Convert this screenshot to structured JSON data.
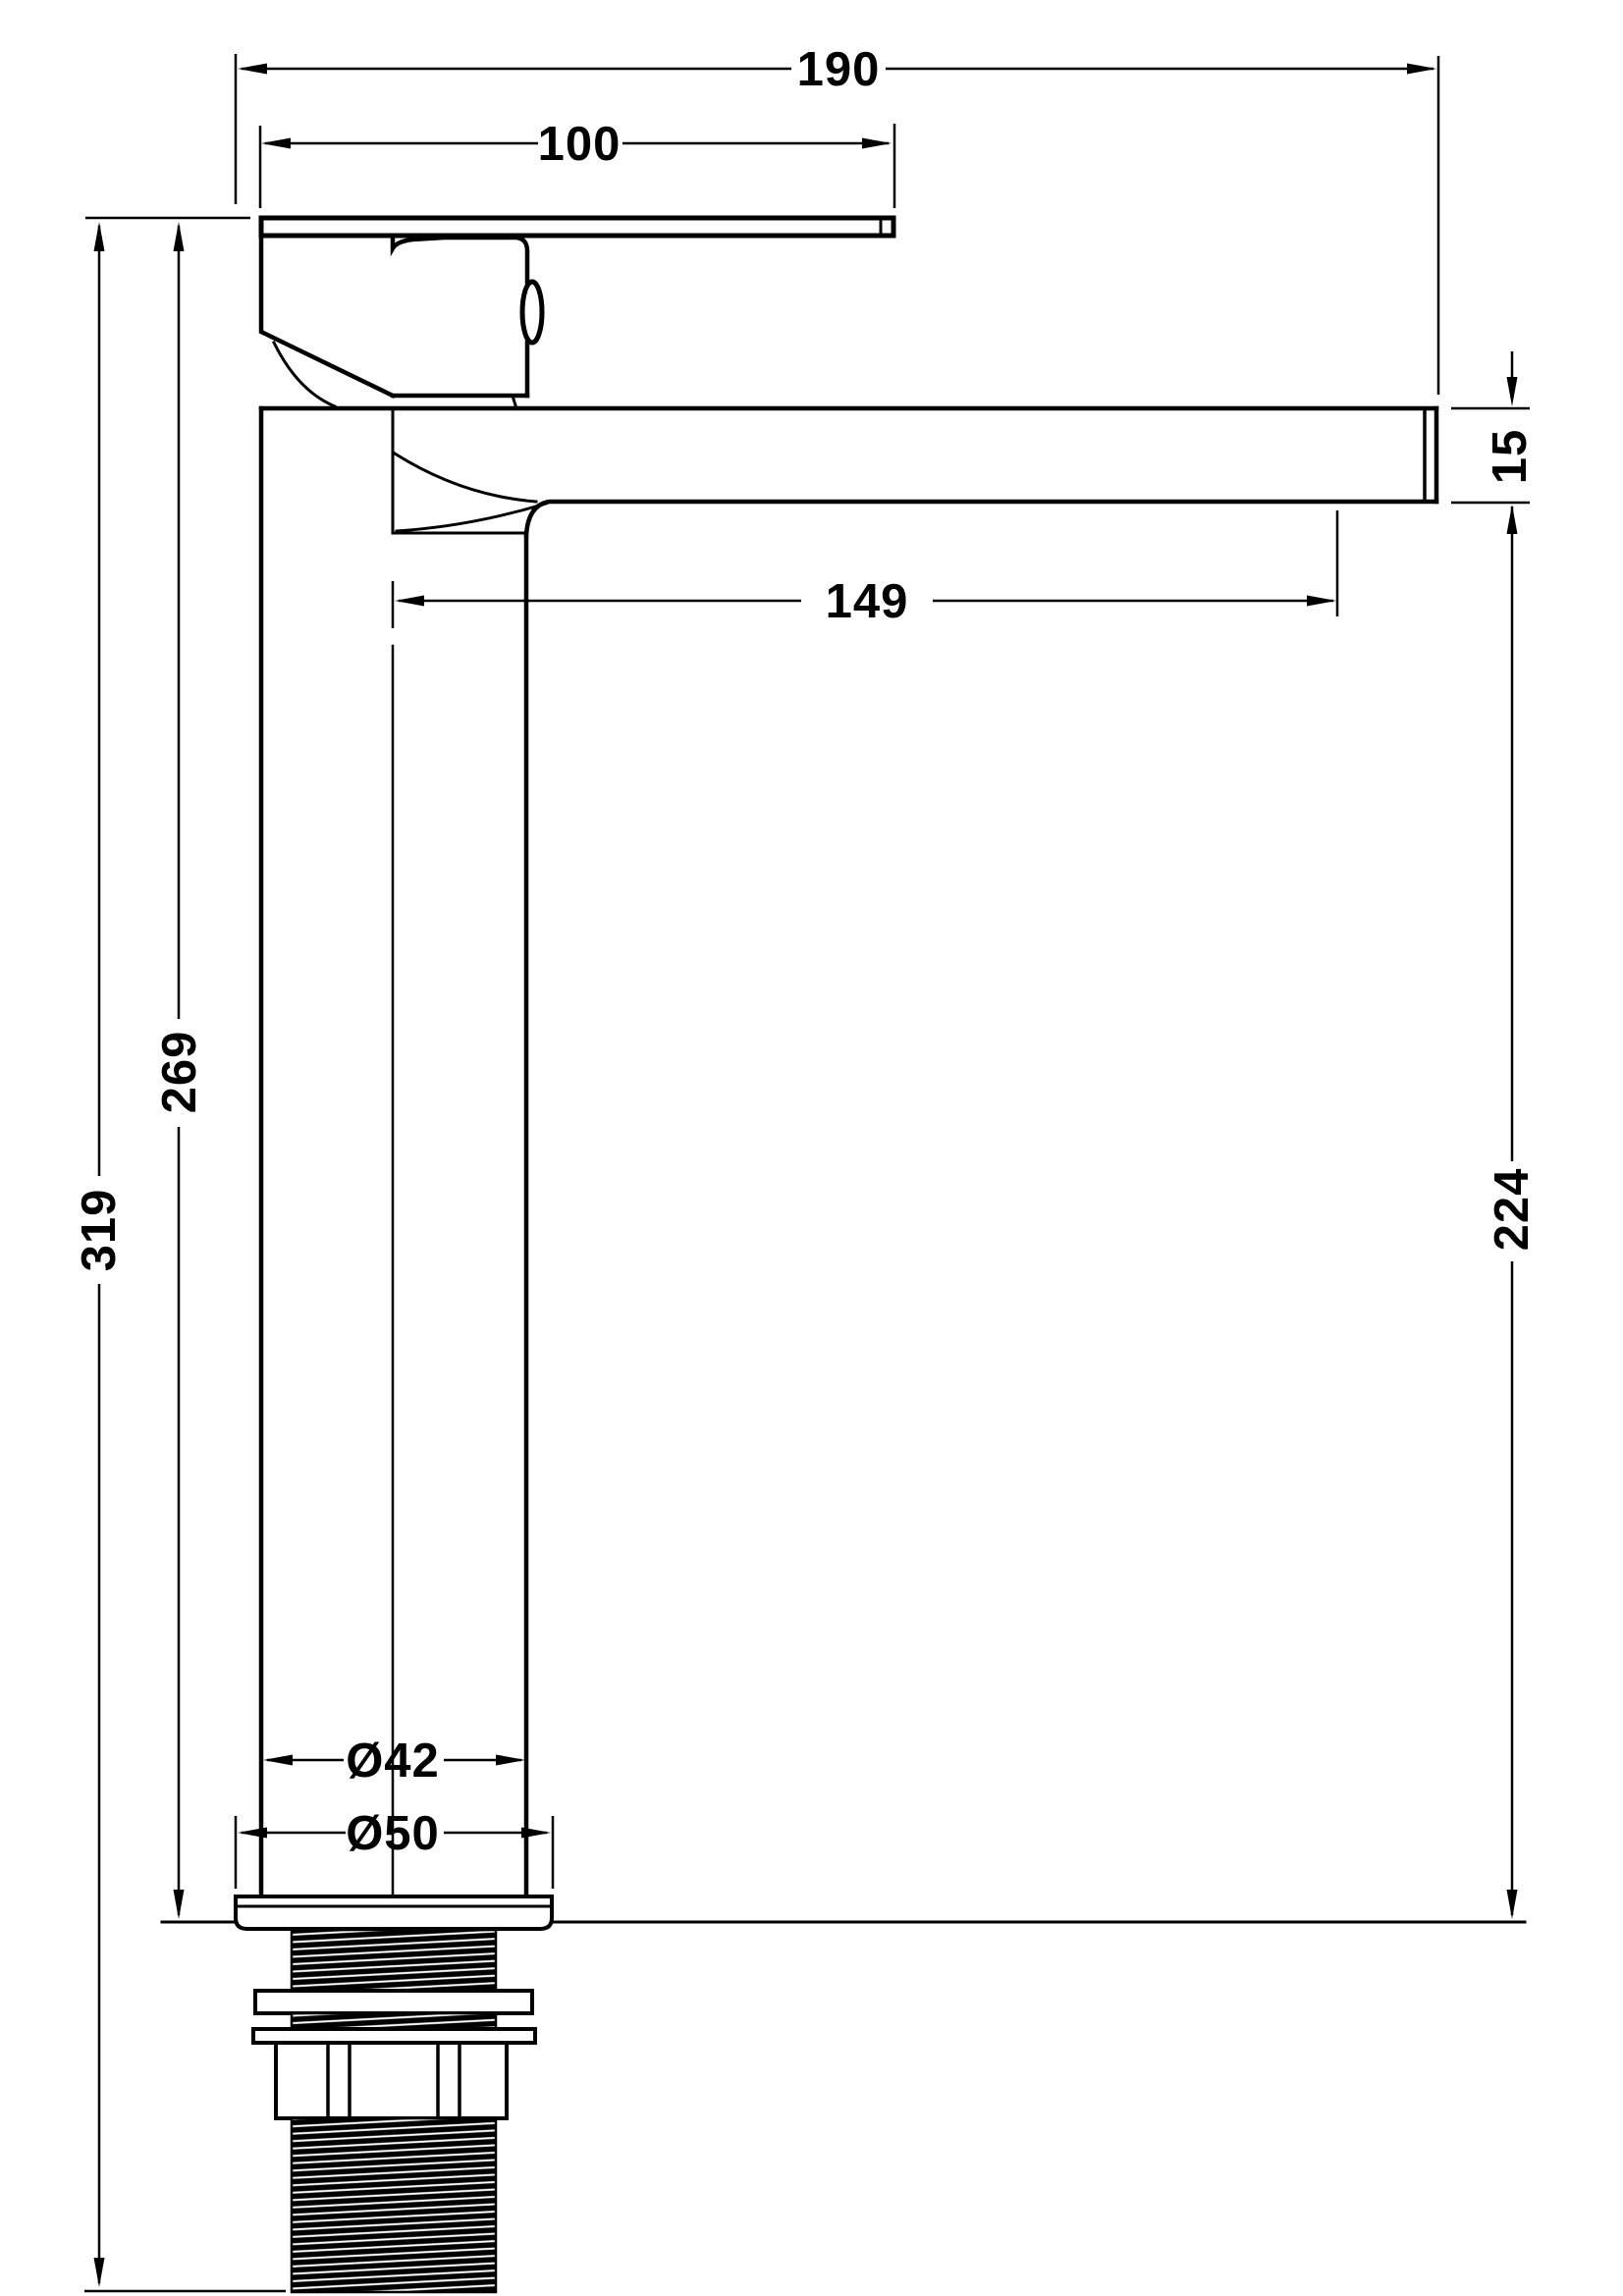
{
  "drawing": {
    "kind": "technical-dimension-drawing",
    "colors": {
      "line": "#000000",
      "background": "#ffffff"
    }
  },
  "dimensions": {
    "d190": {
      "label": "190",
      "orientation": "horizontal"
    },
    "d100": {
      "label": "100",
      "orientation": "horizontal"
    },
    "d149": {
      "label": "149",
      "orientation": "horizontal"
    },
    "d15": {
      "label": "15",
      "orientation": "vertical"
    },
    "d269": {
      "label": "269",
      "orientation": "vertical"
    },
    "d319": {
      "label": "319",
      "orientation": "vertical"
    },
    "d224": {
      "label": "224",
      "orientation": "vertical"
    },
    "d42": {
      "label": "Ø42",
      "orientation": "horizontal"
    },
    "d50": {
      "label": "Ø50",
      "orientation": "horizontal"
    }
  }
}
